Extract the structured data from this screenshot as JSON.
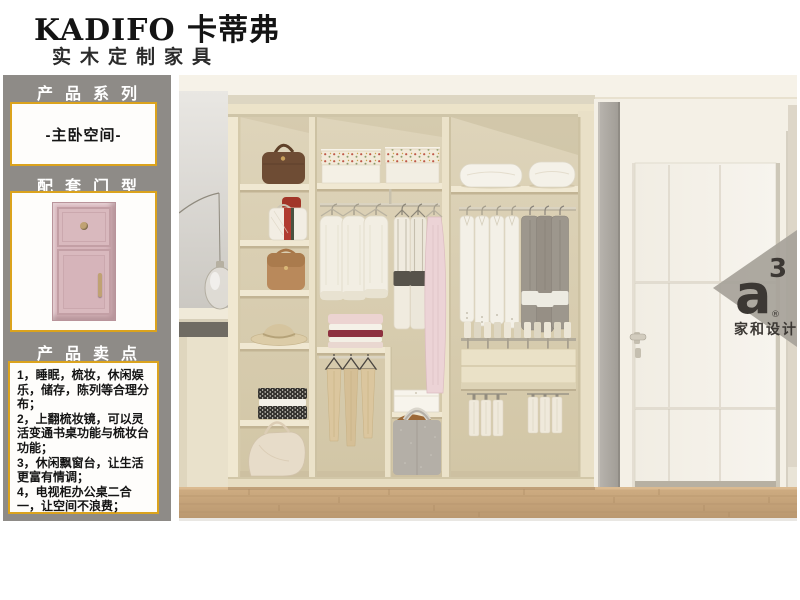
{
  "brand": {
    "name": "KADIFO 卡蒂弗",
    "tagline": "实木定制家具"
  },
  "sidebar": {
    "series_header": "产品系列",
    "series_value": "-主卧空间-",
    "door_header": "配套门型",
    "points_header": "产品卖点",
    "points": [
      "1，睡眠，梳妆，休闲娱乐，储存，陈列等合理分布；",
      "2，上翻梳妆镜，可以灵活变通书桌功能与梳妆台功能；",
      "3，休闲飘窗台，让生活更富有情调；",
      "4，电视柜办公桌二合一，让空间不浪费；"
    ]
  },
  "watermark": {
    "letter": "a",
    "superscript": "3",
    "registered": "®",
    "caption": "家和设计"
  },
  "colors": {
    "accent_border": "#dba31d",
    "sidebar_bg": "#8e8b87",
    "door_pink": "#d7b5bb",
    "watermark_gray": "#a7a39a",
    "wood_floor": "#c7a87e"
  }
}
